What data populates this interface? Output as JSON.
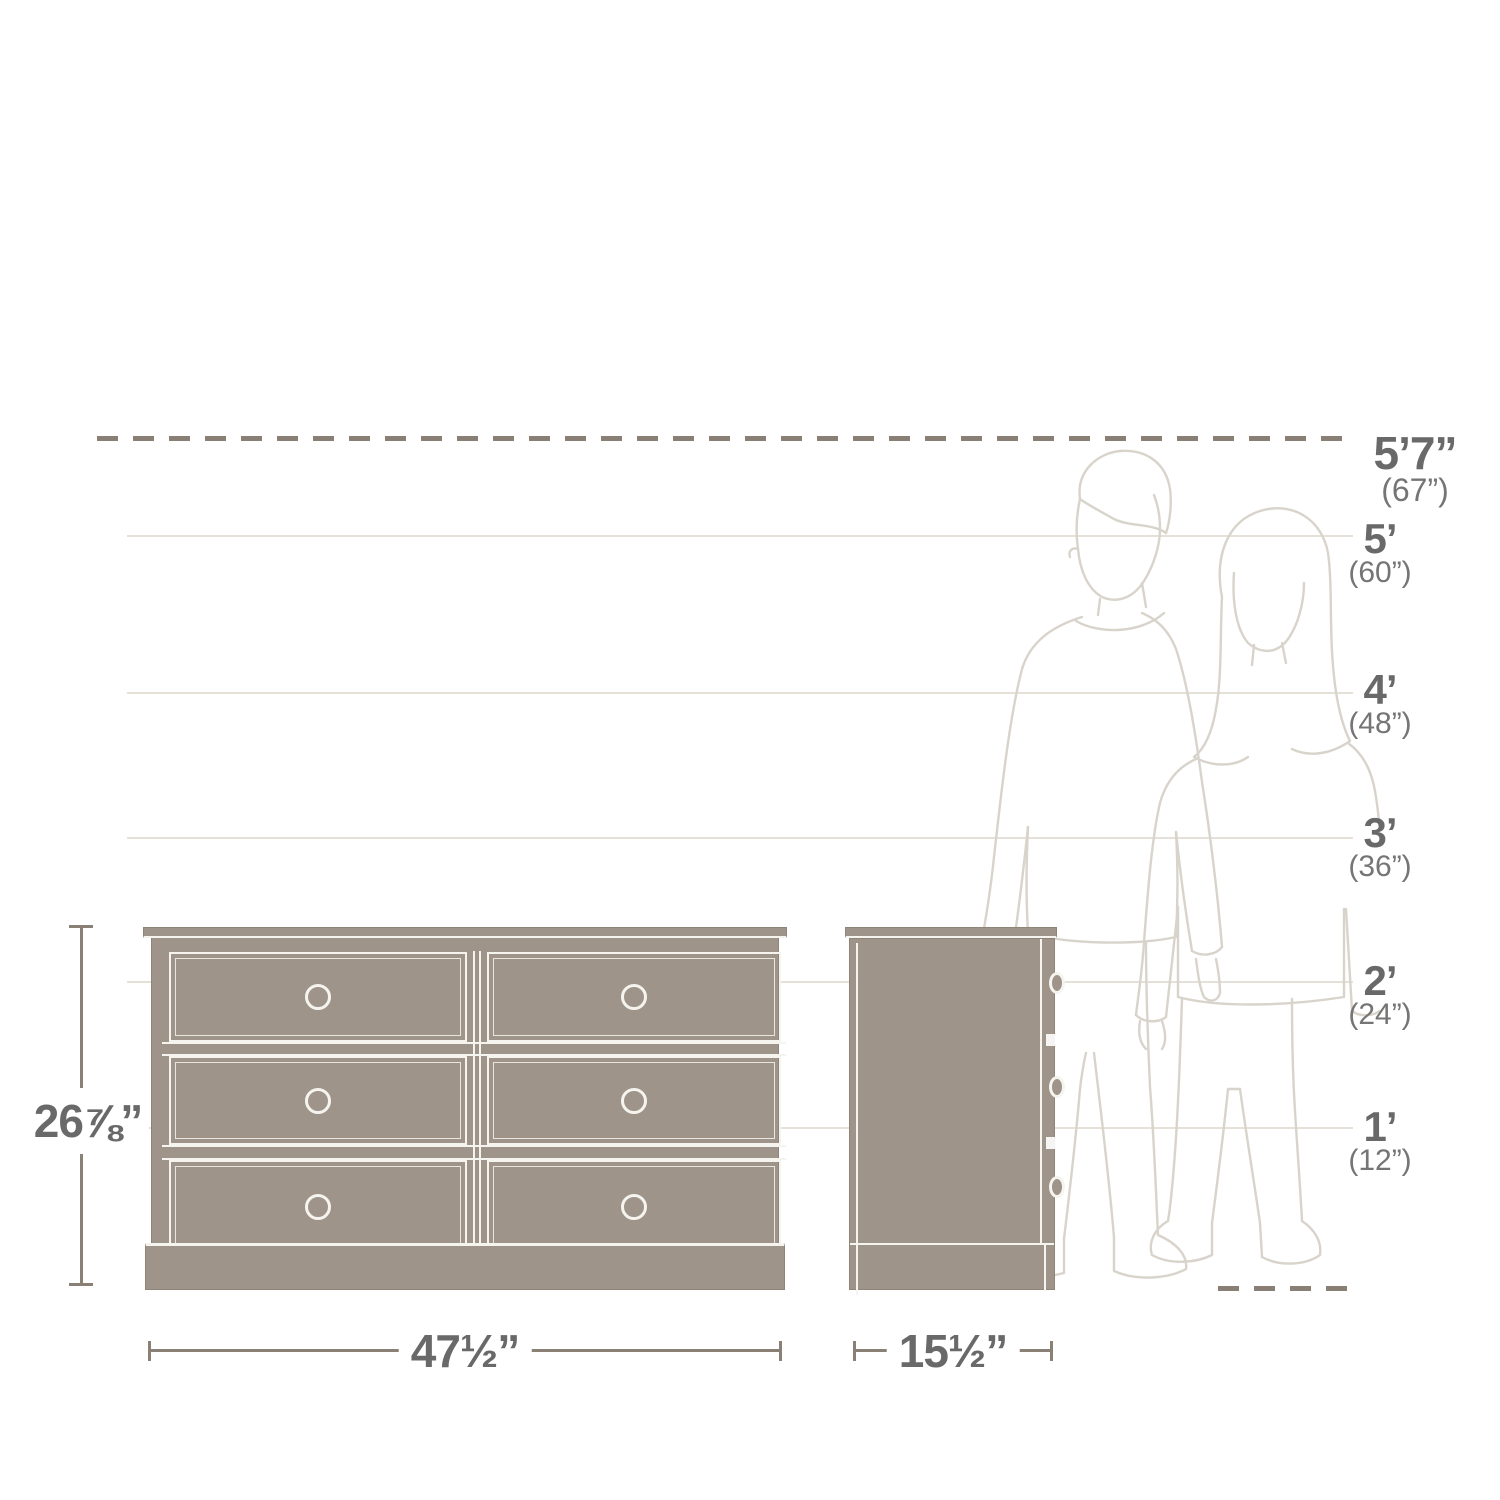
{
  "diagram": {
    "type": "furniture-dimension-diagram",
    "product": "6-drawer dresser, front and side elevation with human height reference",
    "height_markers": [
      {
        "feet": "5’7”",
        "inches": "(67”)",
        "line_style": "dashed"
      },
      {
        "feet": "5’",
        "inches": "(60”)",
        "line_style": "solid"
      },
      {
        "feet": "4’",
        "inches": "(48”)",
        "line_style": "solid"
      },
      {
        "feet": "3’",
        "inches": "(36”)",
        "line_style": "solid"
      },
      {
        "feet": "2’",
        "inches": "(24”)",
        "line_style": "solid"
      },
      {
        "feet": "1’",
        "inches": "(12”)",
        "line_style": "solid"
      }
    ],
    "product_dimensions": {
      "height": "26⅞”",
      "width": "47½”",
      "depth": "15½”"
    },
    "furniture": {
      "front_view_drawers": 6,
      "side_view_knobs": 3
    },
    "colors": {
      "furniture_fill": "#9E948A",
      "furniture_outline": "#F6F4EF",
      "dimension_line": "#8B8076",
      "reference_line": "#E5E1D9",
      "label_text": "#696969",
      "label_subtext": "#757575",
      "figure_line_art": "#D9D4CB",
      "background": "#FFFFFF"
    }
  }
}
